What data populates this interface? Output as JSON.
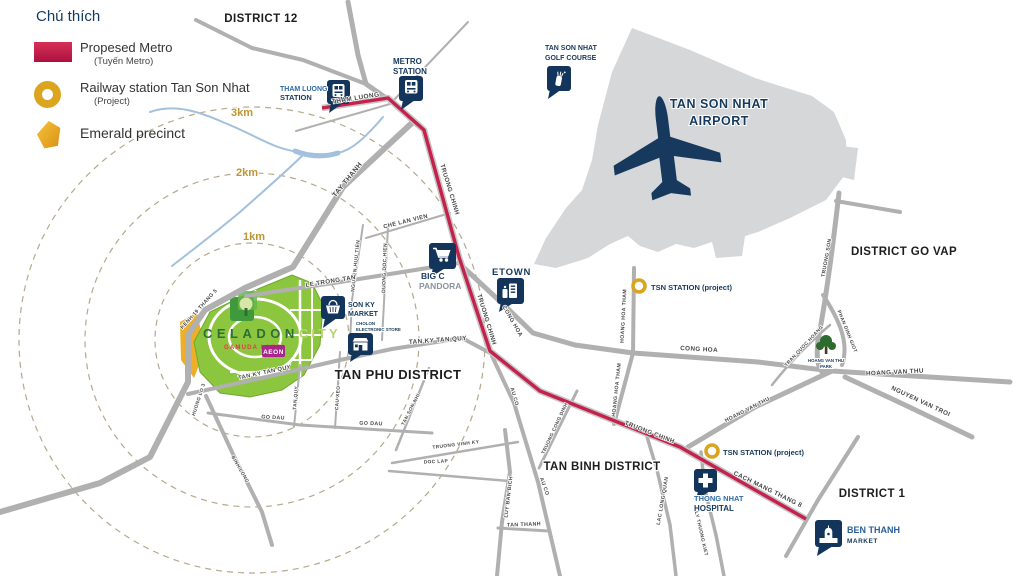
{
  "legend": {
    "title": "Chú thích",
    "items": [
      {
        "label": "Propesed Metro",
        "sublabel": "(Tuyến Metro)"
      },
      {
        "label": "Railway station Tan Son Nhat",
        "sublabel": "(Project)"
      },
      {
        "label": "Emerald precinct",
        "sublabel": ""
      }
    ]
  },
  "colors": {
    "metro_red": "#c4214d",
    "railway_gold": "#dba520",
    "navy": "#16395d",
    "label_blue": "#2e6ba8",
    "airport_gray": "#d5d7d9",
    "celadon_green": "#8cc63e",
    "km_gold": "#bf9434"
  },
  "districts": [
    {
      "label": "DISTRICT 12"
    },
    {
      "label": "DISTRICT GO VAP"
    },
    {
      "label": "TAN PHU DISTRICT"
    },
    {
      "label": "TAN BINH DISTRICT"
    },
    {
      "label": "DISTRICT 1"
    }
  ],
  "rings": [
    {
      "label": "1km"
    },
    {
      "label": "2km"
    },
    {
      "label": "3km"
    }
  ],
  "pois": {
    "tham_luong": {
      "line1": "THAM LUONG",
      "line2": "STATION"
    },
    "metro_station": {
      "line1": "METRO",
      "line2": "STATION"
    },
    "golf": {
      "line1": "TAN SON NHAT",
      "line2": "GOLF COURSE"
    },
    "airport": {
      "line1": "TAN SON NHAT",
      "line2": "AIRPORT"
    },
    "bigc": {
      "line1": "BIG C",
      "line2": "PANDORA"
    },
    "etown": {
      "label": "ETOWN"
    },
    "sonky": {
      "line1": "SON KY",
      "line2": "MARKET"
    },
    "cholon": {
      "line1": "CHOLON",
      "line2": "ELECTRONIC STORE"
    },
    "tsn_station_1": {
      "label": "TSN STATION (project)"
    },
    "tsn_station_2": {
      "label": "TSN STATION (project)"
    },
    "hospital": {
      "line1": "THONG NHAT",
      "line2": "HOSPITAL"
    },
    "ben_thanh": {
      "line1": "BEN THANH",
      "line2": "MARKET"
    },
    "park": {
      "line1": "HOANG VAN THU",
      "line2": "PARK"
    },
    "celadon": {
      "name1": "CELADON",
      "name2": "CITY",
      "developer": "GAMUDA LAND",
      "store": "AEON"
    }
  },
  "road_labels": [
    {
      "label": "THAM LUONG",
      "x": 356,
      "y": 100,
      "rot": -9,
      "size": 6.5
    },
    {
      "label": "TAY THANH",
      "x": 349,
      "y": 181,
      "rot": -51,
      "size": 7
    },
    {
      "label": "CHE LAN VIEN",
      "x": 406,
      "y": 223,
      "rot": -14,
      "size": 5.8
    },
    {
      "label": "NGUYEN HUU TIEN",
      "x": 357,
      "y": 266,
      "rot": -84,
      "size": 5
    },
    {
      "label": "DUONG DOC HIEN",
      "x": 386,
      "y": 268,
      "rot": -88,
      "size": 5
    },
    {
      "label": "LE TRONG TAN",
      "x": 331,
      "y": 283,
      "rot": -9,
      "size": 6.2
    },
    {
      "label": "KENH 19 THANG 5",
      "x": 200,
      "y": 310,
      "rot": -48,
      "size": 5.2
    },
    {
      "label": "TRUONG CHINH",
      "x": 448,
      "y": 190,
      "rot": 73,
      "size": 6.2
    },
    {
      "label": "TRUONG CHINH",
      "x": 485,
      "y": 320,
      "rot": 73,
      "size": 6.2
    },
    {
      "label": "TRUONG CHINH",
      "x": 649,
      "y": 434,
      "rot": 21,
      "size": 6.2
    },
    {
      "label": "CONG HOA",
      "x": 511,
      "y": 322,
      "rot": 60,
      "size": 5.8
    },
    {
      "label": "CONG HOA",
      "x": 699,
      "y": 351,
      "rot": 3,
      "size": 6.3
    },
    {
      "label": "TAN KY TAN QUY",
      "x": 438,
      "y": 342,
      "rot": -4,
      "size": 6.3
    },
    {
      "label": "TAN KY TAN QUY",
      "x": 265,
      "y": 374,
      "rot": -12,
      "size": 5.8
    },
    {
      "label": "TAN QUY",
      "x": 297,
      "y": 398,
      "rot": -85,
      "size": 4.8
    },
    {
      "label": "CAU XEO",
      "x": 339,
      "y": 398,
      "rot": -86,
      "size": 4.8
    },
    {
      "label": "GO DAU",
      "x": 273,
      "y": 419,
      "rot": 3,
      "size": 5.3
    },
    {
      "label": "GO DAU",
      "x": 371,
      "y": 425,
      "rot": 2,
      "size": 5.3
    },
    {
      "label": "HUONG LO 3",
      "x": 200,
      "y": 400,
      "rot": -72,
      "size": 4.8
    },
    {
      "label": "BINH LONG",
      "x": 239,
      "y": 470,
      "rot": 60,
      "size": 4.8
    },
    {
      "label": "TAN SON NHI",
      "x": 412,
      "y": 410,
      "rot": -63,
      "size": 4.8
    },
    {
      "label": "TRUONG VINH KY",
      "x": 456,
      "y": 446,
      "rot": -7,
      "size": 4.8
    },
    {
      "label": "DOC LAP",
      "x": 436,
      "y": 463,
      "rot": -3,
      "size": 4.8
    },
    {
      "label": "LUY BAN BICH",
      "x": 510,
      "y": 497,
      "rot": -83,
      "size": 5.2
    },
    {
      "label": "TAN THANH",
      "x": 524,
      "y": 526,
      "rot": -2,
      "size": 5.3
    },
    {
      "label": "AU CO",
      "x": 513,
      "y": 397,
      "rot": 74,
      "size": 5.2
    },
    {
      "label": "AU CO",
      "x": 543,
      "y": 487,
      "rot": 70,
      "size": 5.2
    },
    {
      "label": "TRUONG CONG DINH",
      "x": 556,
      "y": 429,
      "rot": -65,
      "size": 4.8
    },
    {
      "label": "LAC LONG QUAN",
      "x": 664,
      "y": 501,
      "rot": -80,
      "size": 5.2
    },
    {
      "label": "LY THUONG KIET",
      "x": 700,
      "y": 534,
      "rot": 77,
      "size": 4.8
    },
    {
      "label": "HOANG HOA THAM",
      "x": 625,
      "y": 316,
      "rot": -87,
      "size": 5.2
    },
    {
      "label": "HOANG HOA THAM",
      "x": 618,
      "y": 390,
      "rot": -84,
      "size": 5.2
    },
    {
      "label": "HOANG VAN THU",
      "x": 748,
      "y": 411,
      "rot": -27,
      "size": 5.3
    },
    {
      "label": "HOANG VAN THU",
      "x": 895,
      "y": 374,
      "rot": -3,
      "size": 6.3
    },
    {
      "label": "NGUYEN VAN TROI",
      "x": 920,
      "y": 403,
      "rot": 25,
      "size": 6.3
    },
    {
      "label": "CACH MANG THANG 8",
      "x": 767,
      "y": 491,
      "rot": 26,
      "size": 6.3
    },
    {
      "label": "PHAN DINH GIOT",
      "x": 846,
      "y": 332,
      "rot": 68,
      "size": 4.8
    },
    {
      "label": "TRAN QUOC HOANG",
      "x": 805,
      "y": 347,
      "rot": -47,
      "size": 4.8
    },
    {
      "label": "TRUONG SON",
      "x": 828,
      "y": 258,
      "rot": -80,
      "size": 5.2
    }
  ]
}
